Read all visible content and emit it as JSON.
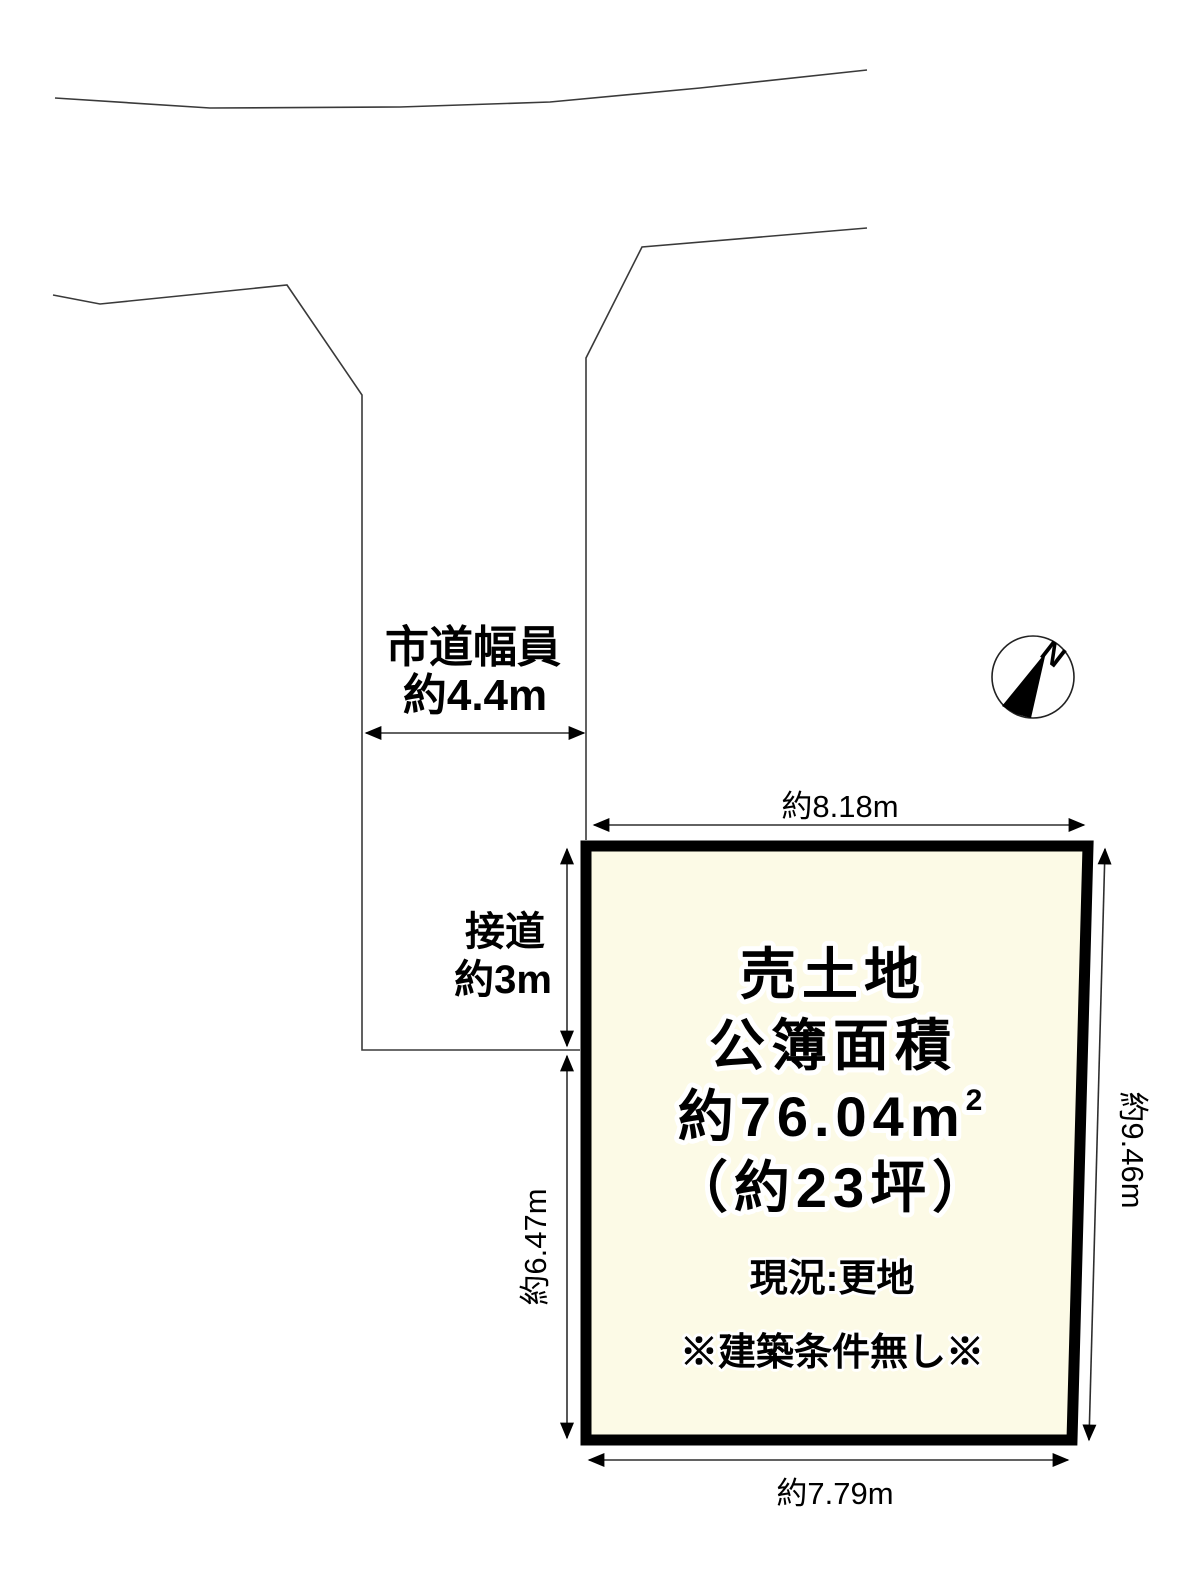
{
  "compass": {
    "north_label": "N"
  },
  "road": {
    "width_label": "市道幅員",
    "width_value": "約4.4m",
    "frontage_label": "接道",
    "frontage_value": "約3m"
  },
  "parcel": {
    "title": "売土地",
    "area_label": "公簿面積",
    "area_value": "約76.04m",
    "area_superscript": "2",
    "tsubo_value": "（約23坪）",
    "status": "現況:更地",
    "note": "※建築条件無し※"
  },
  "dimensions": {
    "top": "約8.18m",
    "right": "約9.46m",
    "bottom": "約7.79m",
    "left": "約6.47m"
  },
  "colors": {
    "parcel_fill": "#fcfae6",
    "parcel_border": "#000000",
    "line": "#3a3a3a",
    "text": "#000000",
    "background": "#ffffff"
  }
}
